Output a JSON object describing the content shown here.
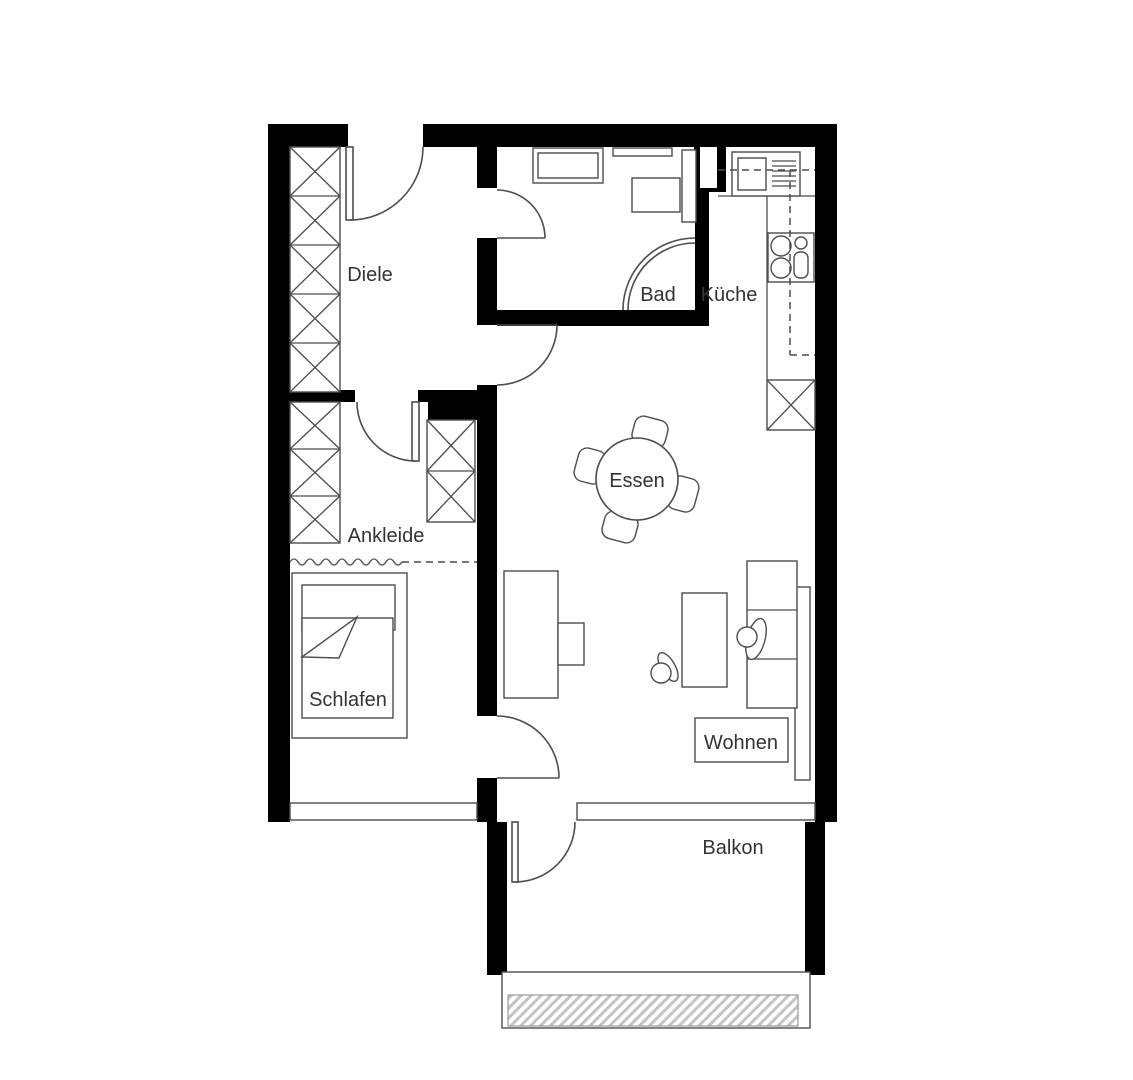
{
  "plan": {
    "type": "apartment-floor-plan",
    "rooms": {
      "diele": {
        "label": "Diele"
      },
      "bad": {
        "label": "Bad"
      },
      "kueche": {
        "label": "Küche"
      },
      "essen": {
        "label": "Essen"
      },
      "ankleide": {
        "label": "Ankleide"
      },
      "schlafen": {
        "label": "Schlafen"
      },
      "wohnen": {
        "label": "Wohnen"
      },
      "balkon": {
        "label": "Balkon"
      }
    },
    "colors": {
      "wall": "#000000",
      "furniture_line": "#4d4d4d",
      "text": "#333333",
      "hatch": "#c4c4c4",
      "background": "#ffffff"
    }
  }
}
